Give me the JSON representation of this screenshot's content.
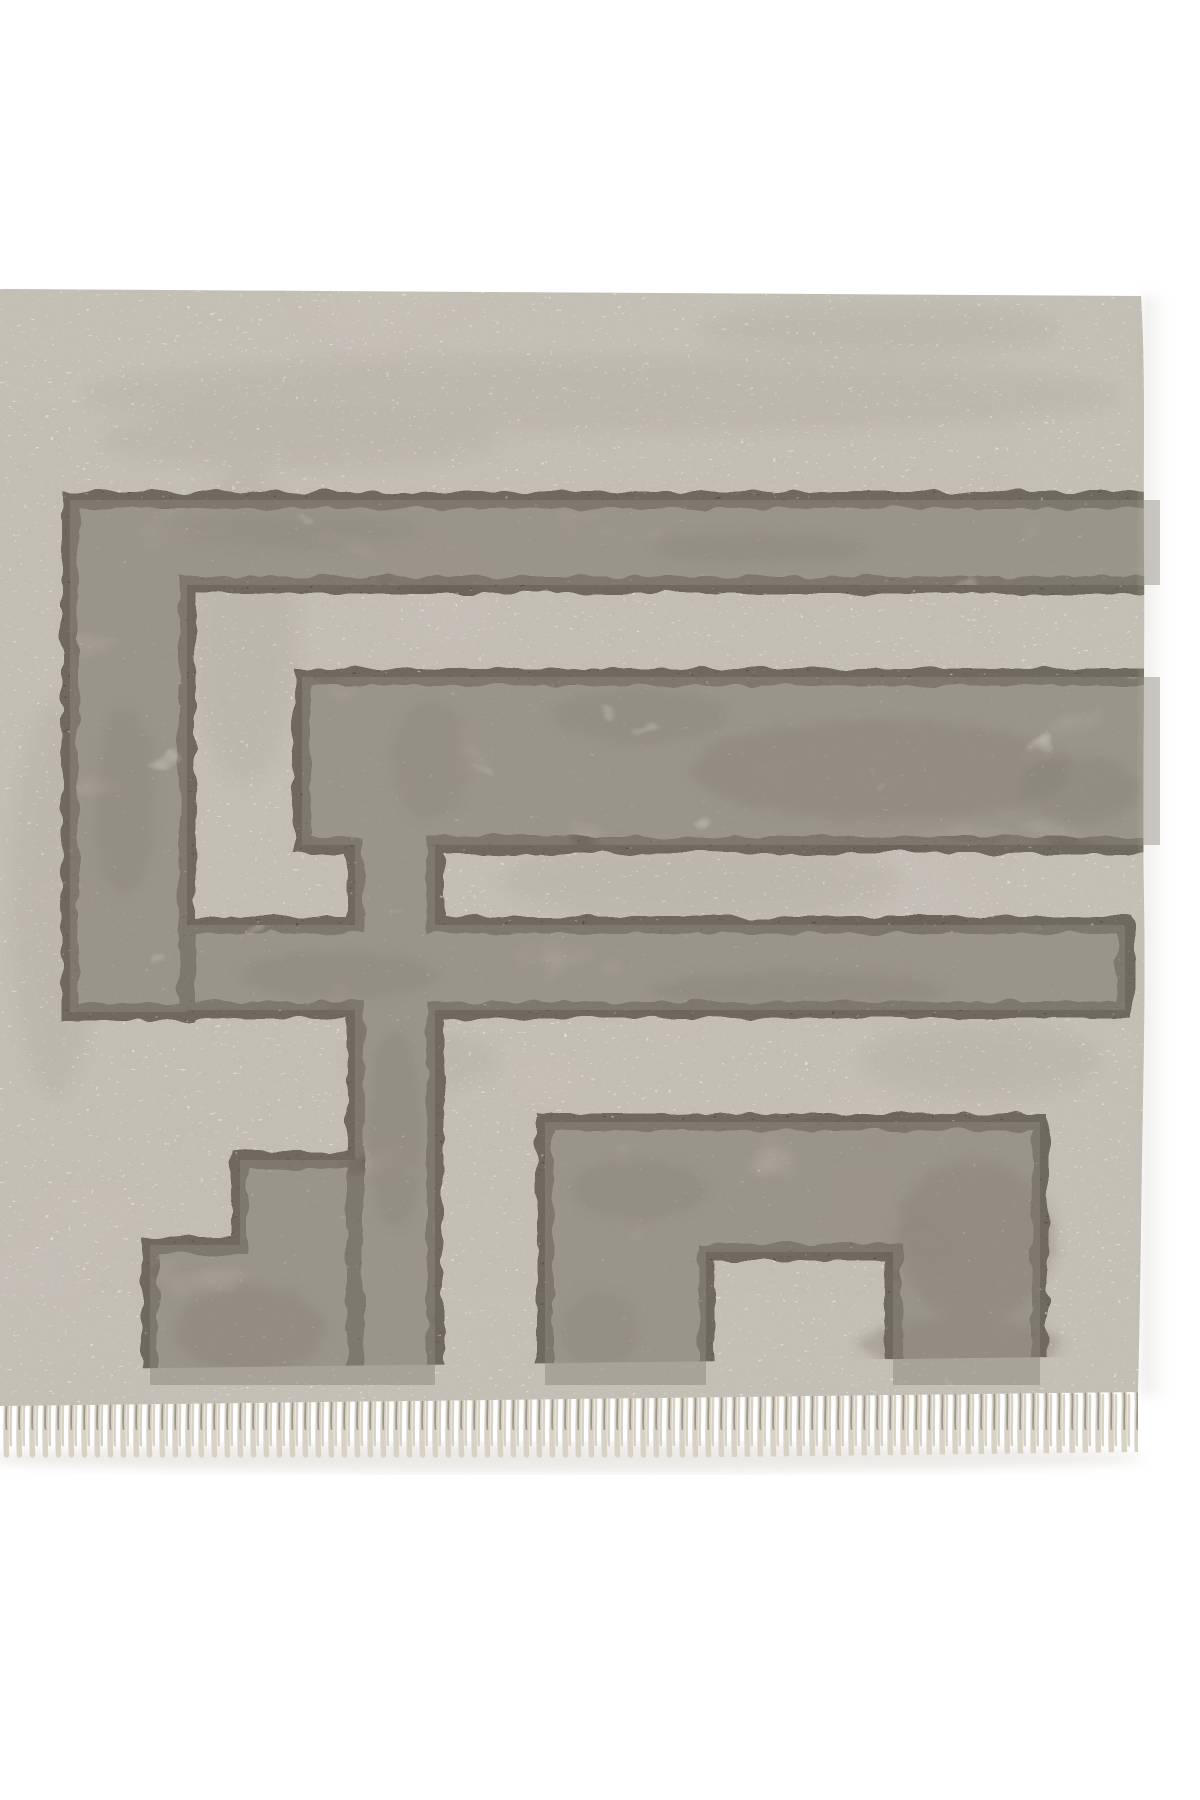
{
  "photo": {
    "alt": "Close-up of a cream flatweave rug corner with a dark charcoal geometric Greek key maze pattern, mottled gray infill bands, and a short tassel fringe along the bottom edge",
    "subject": "rug-corner-closeup"
  },
  "colors": {
    "page_bg": "#ffffff",
    "rug_ground": "#e8e3d9",
    "pattern_fill": "#b2aca2",
    "pattern_line": "#4b4339",
    "ground_streak": "#8a8479",
    "selvage": "#eae5da",
    "fringe_strand": "#d8d2c4",
    "fringe_dark": "#9d968a",
    "shadow": "#d8d4cb"
  }
}
